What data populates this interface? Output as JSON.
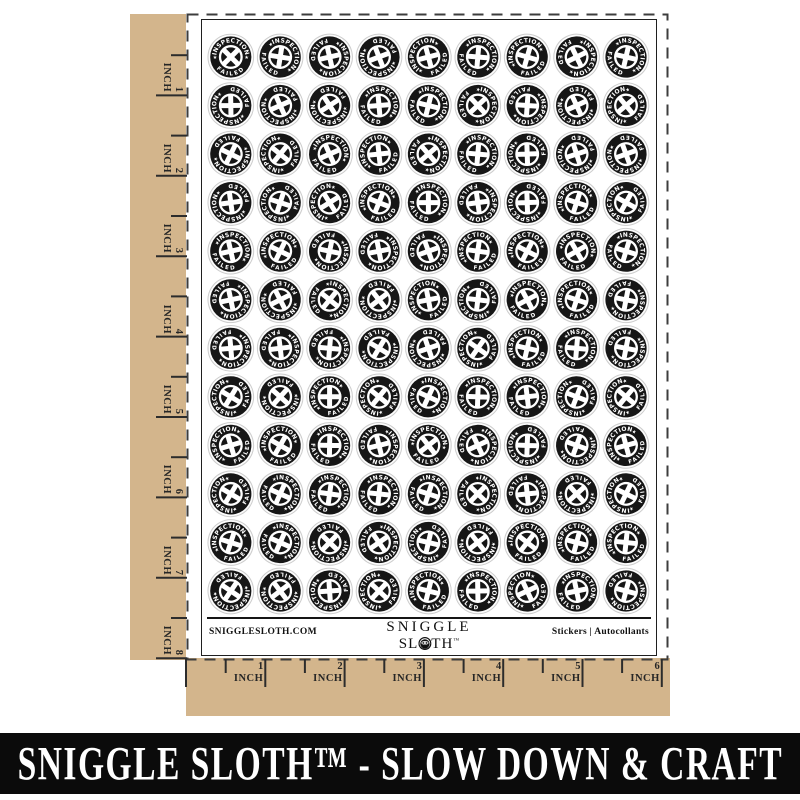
{
  "banner": {
    "text": "SNIGGLE SLOTH™ - SLOW DOWN & CRAFT",
    "bg": "#0b0b0b",
    "fg": "#ffffff"
  },
  "sheet": {
    "footer": {
      "website": "SNIGGLESLOTH.COM",
      "brand_line1": "SNIGGLE",
      "brand_line2_pre": "SL",
      "brand_line2_post": "TH",
      "trademark": "™",
      "right": "Stickers | Autocollants"
    },
    "sticker": {
      "top_text": "INSPECTION",
      "bottom_text": "FAILED",
      "star": "★",
      "ink": "#161616",
      "die_cut": "#fcfcfc"
    },
    "grid": {
      "rows": 12,
      "cols": 9,
      "count": 108
    }
  },
  "rulers": {
    "unit": "INCH",
    "left_numbers": [
      "1",
      "2",
      "3",
      "4",
      "5",
      "6",
      "7",
      "8"
    ],
    "bottom_numbers": [
      "1",
      "2",
      "3",
      "4",
      "5",
      "6"
    ],
    "color": "#d3b58c",
    "tick_color": "#2c2c2c"
  }
}
